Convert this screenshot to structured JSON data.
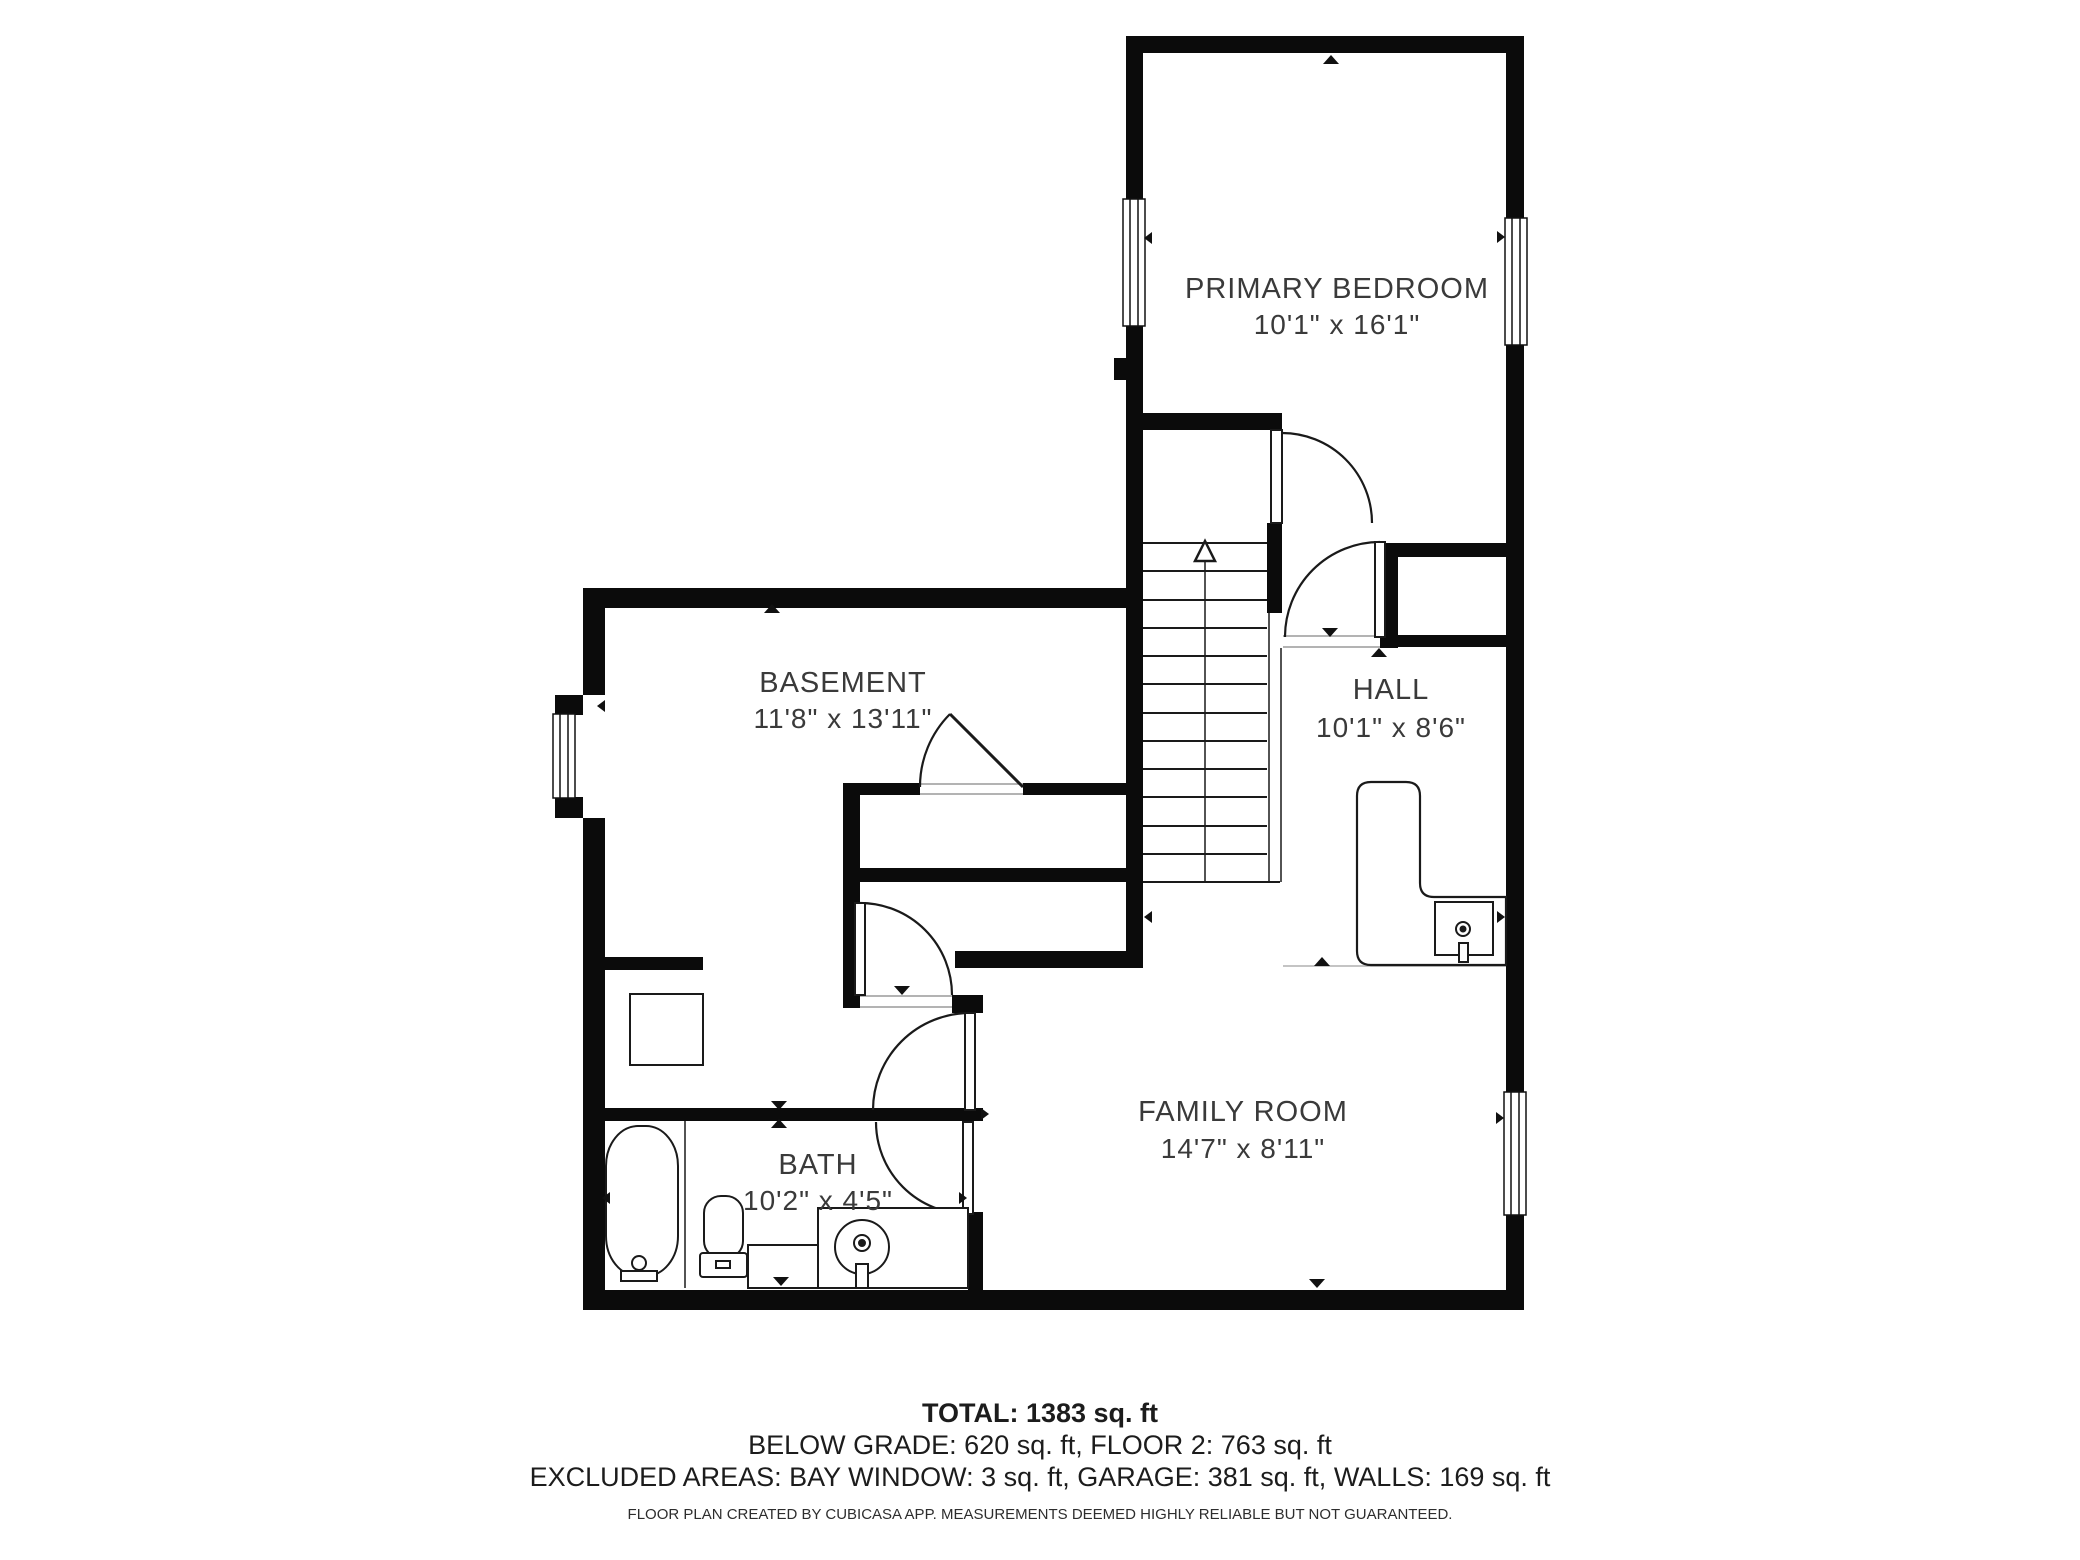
{
  "rooms": {
    "primary_bedroom": {
      "name": "PRIMARY BEDROOM",
      "dims": "10'1\" x 16'1\""
    },
    "basement": {
      "name": "BASEMENT",
      "dims": "11'8\" x 13'11\""
    },
    "hall": {
      "name": "HALL",
      "dims": "10'1\" x 8'6\""
    },
    "family_room": {
      "name": "FAMILY ROOM",
      "dims": "14'7\" x 8'11\""
    },
    "bath": {
      "name": "BATH",
      "dims": "10'2\" x 4'5\""
    }
  },
  "summary": {
    "total": "TOTAL: 1383 sq. ft",
    "areas": "BELOW GRADE: 620 sq. ft, FLOOR 2: 763 sq. ft",
    "excluded": "EXCLUDED AREAS: BAY WINDOW: 3 sq. ft, GARAGE: 381 sq. ft, WALLS: 169 sq. ft",
    "disclaimer": "FLOOR PLAN CREATED BY CUBICASA APP. MEASUREMENTS DEEMED HIGHLY RELIABLE BUT NOT GUARANTEED."
  },
  "colors": {
    "wall": "#0b0b0b",
    "line": "#1a1a1a",
    "text": "#3a3a3a",
    "threshold": "#9a9a9a"
  },
  "fixtures": [
    "stairs",
    "bathtub",
    "toilet",
    "vanity-sink",
    "counter",
    "kitchenette-counter",
    "kitchen-sink",
    "water-heater"
  ]
}
